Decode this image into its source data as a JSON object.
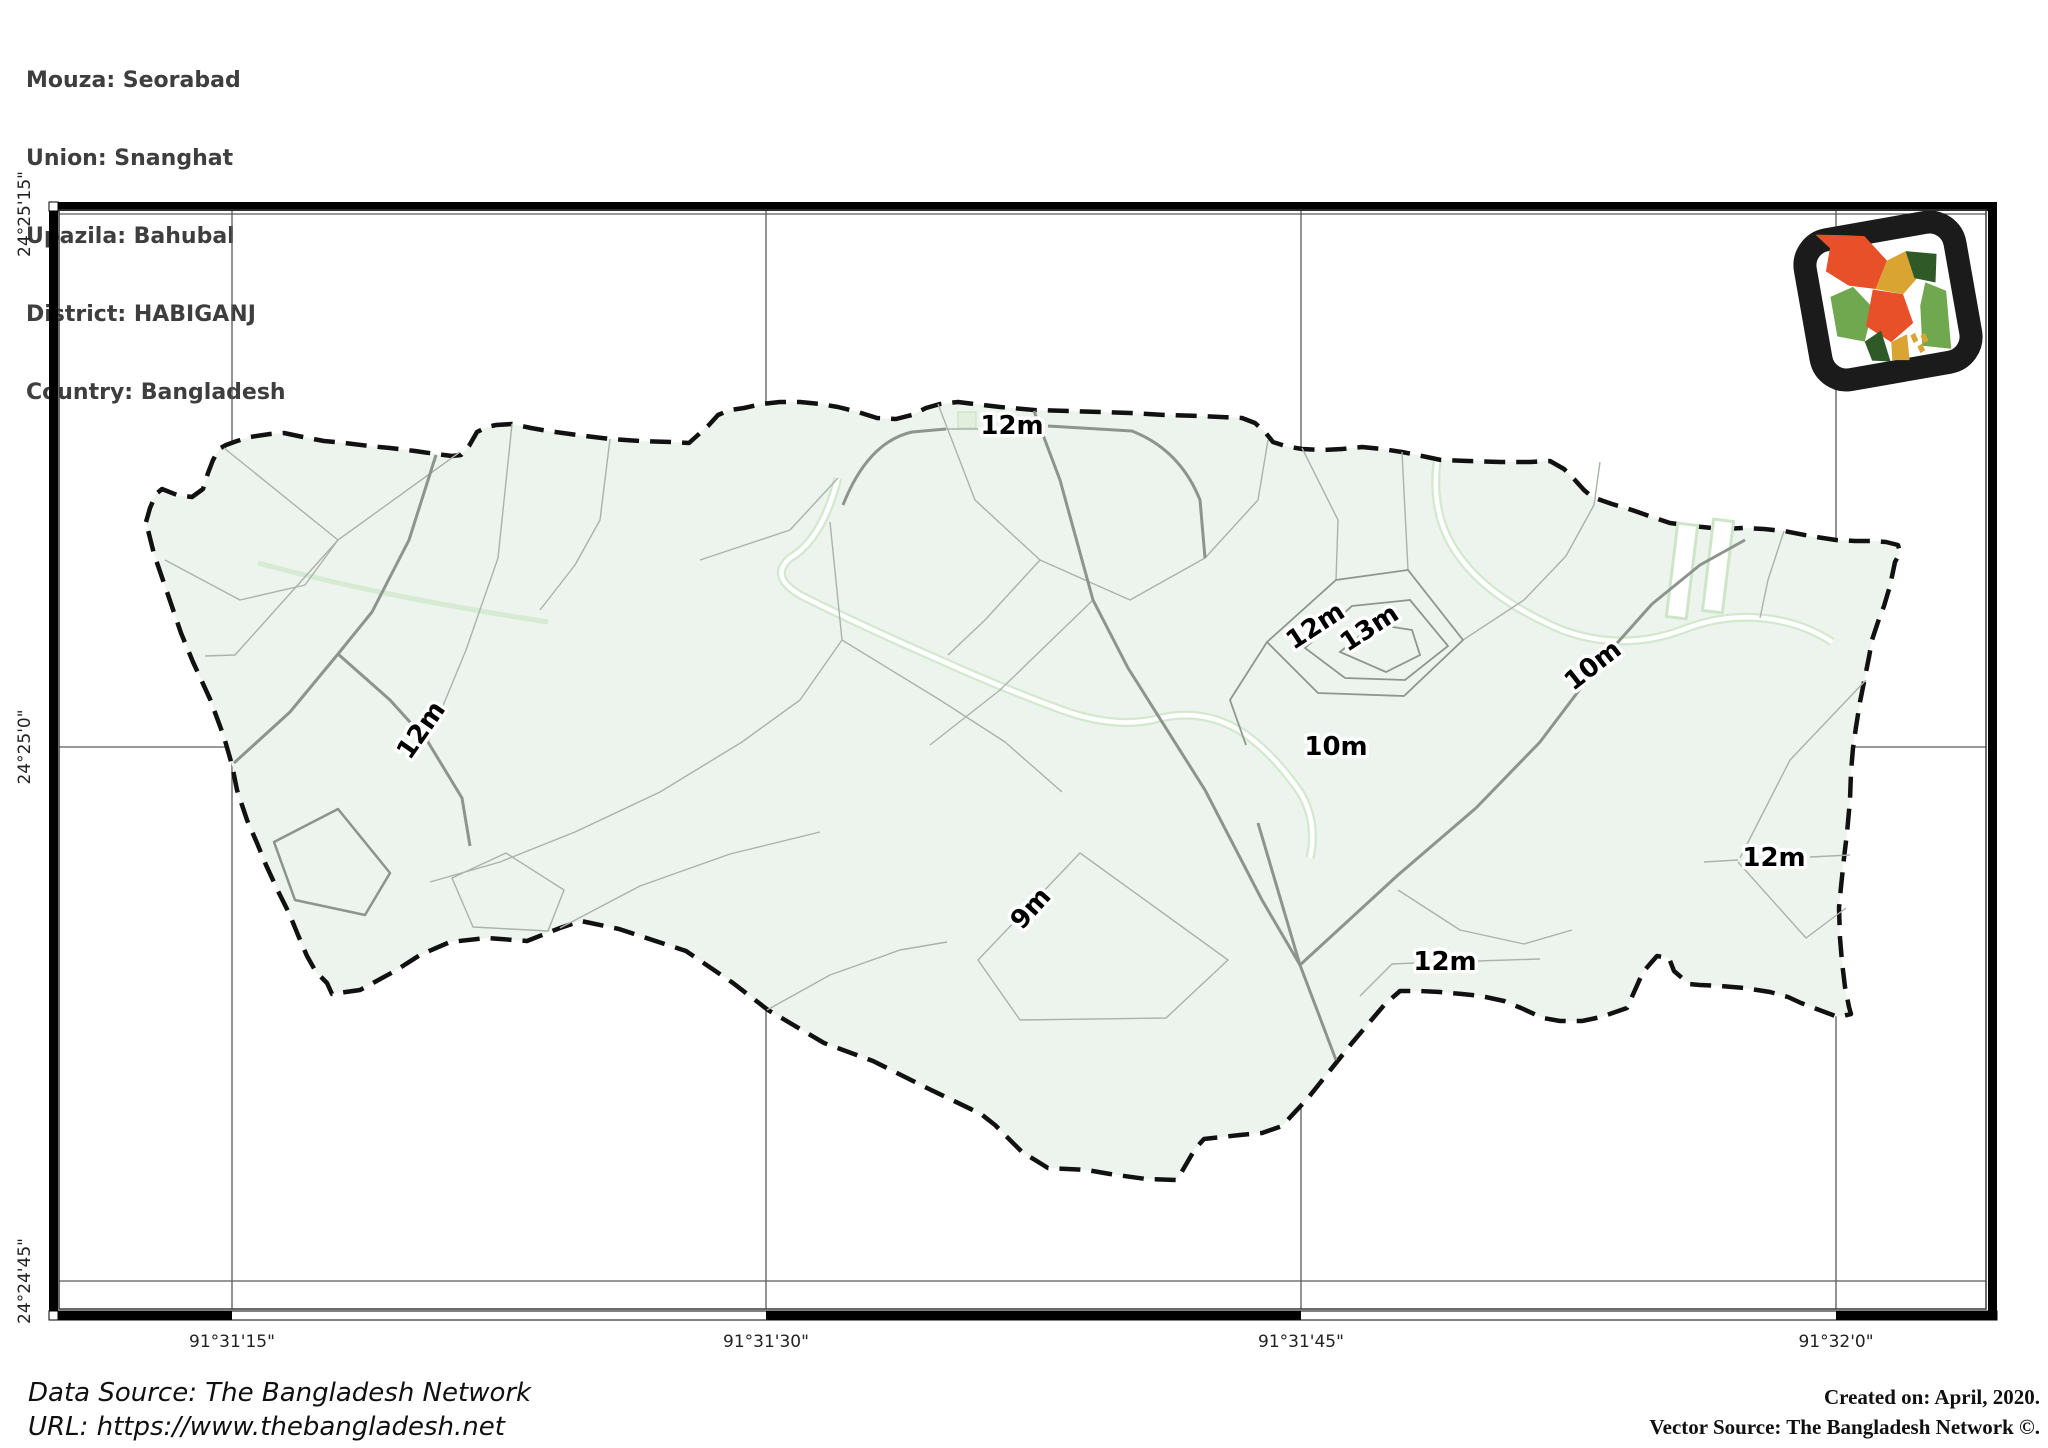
{
  "header": {
    "lines": [
      "Mouza: Seorabad",
      "Union: Snanghat",
      "Upazila: Bahubal",
      "District: HABIGANJ",
      "Country: Bangladesh"
    ]
  },
  "footer": {
    "data_source": "Data Source: The Bangladesh Network",
    "url": "URL: https://www.thebangladesh.net",
    "created": "Created on: April, 2020.",
    "vector_source": "Vector Source: The Bangladesh Network ©."
  },
  "axis": {
    "x_labels": [
      {
        "text": "91°31'15\"",
        "x": 232
      },
      {
        "text": "91°31'30\"",
        "x": 766
      },
      {
        "text": "91°31'45\"",
        "x": 1301
      },
      {
        "text": "91°32'0\"",
        "x": 1836
      }
    ],
    "y_labels": [
      {
        "text": "24°25'15\"",
        "y": 214
      },
      {
        "text": "24°25'0\"",
        "y": 747
      },
      {
        "text": "24°24'45\"",
        "y": 1281
      }
    ],
    "frame": {
      "left": 49,
      "top": 202,
      "right": 1997,
      "bottom": 1320
    }
  },
  "contour_labels": [
    {
      "text": "12m",
      "x": 1012,
      "y": 434,
      "rot": 0
    },
    {
      "text": "12m",
      "x": 428,
      "y": 735,
      "rot": -55
    },
    {
      "text": "12m",
      "x": 1320,
      "y": 633,
      "rot": -33
    },
    {
      "text": "13m",
      "x": 1374,
      "y": 635,
      "rot": -33
    },
    {
      "text": "10m",
      "x": 1598,
      "y": 672,
      "rot": -38
    },
    {
      "text": "10m",
      "x": 1336,
      "y": 755,
      "rot": 0
    },
    {
      "text": "9m",
      "x": 1037,
      "y": 914,
      "rot": -48
    },
    {
      "text": "12m",
      "x": 1445,
      "y": 970,
      "rot": 0
    },
    {
      "text": "12m",
      "x": 1774,
      "y": 866,
      "rot": 0
    }
  ],
  "colors": {
    "region_fill": "#ecf4ed",
    "boundary": "#111111",
    "contour": "#8d938d",
    "parcel": "#aab2aa",
    "stream": "#cfe5c9",
    "grid": "#5a5a5a",
    "frame": "#000000",
    "label_halo": "#ffffff",
    "logo_frame": "#1b1b1b",
    "logo_red": "#e8502a",
    "logo_green": "#6fa84e",
    "logo_dark_green": "#2f5a28",
    "logo_gold": "#d9a431"
  }
}
